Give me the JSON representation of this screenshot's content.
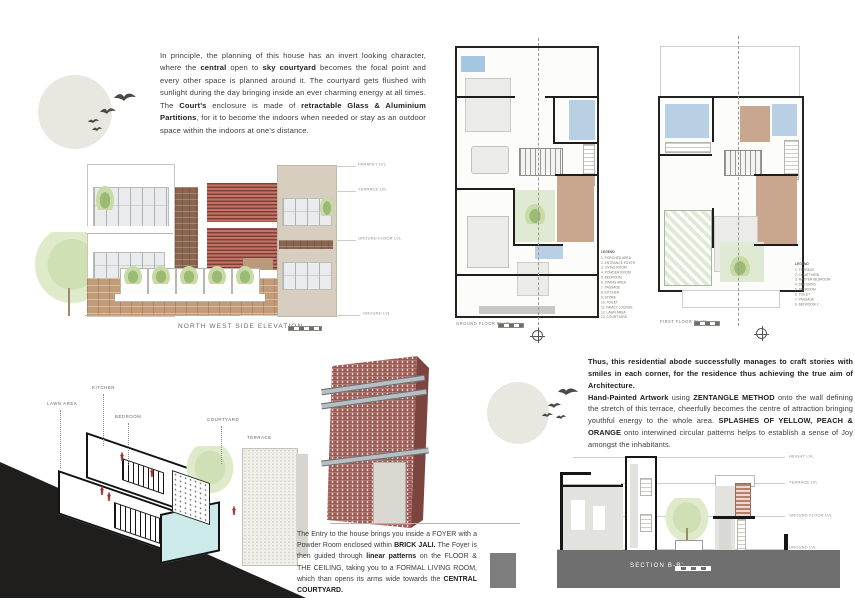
{
  "intro": {
    "segments": [
      {
        "text": "In principle, the planning of this house has an invert looking character, where the ",
        "bold": false
      },
      {
        "text": "central",
        "bold": true
      },
      {
        "text": " open to ",
        "bold": false
      },
      {
        "text": "sky courtyard",
        "bold": true
      },
      {
        "text": " becomes the focal point and every other space is planned around it. The courtyard gets flushed with sunlight during the day bringing inside an ever charming energy at all times. The ",
        "bold": false
      },
      {
        "text": "Court's",
        "bold": true
      },
      {
        "text": " enclosure is made of ",
        "bold": false
      },
      {
        "text": "retractable Glass & Aluminium Partitions",
        "bold": true
      },
      {
        "text": ", for it to become the indoors when needed or stay as an outdoor space within the indoors at one's distance.",
        "bold": false
      }
    ]
  },
  "elevation": {
    "title": "NORTH WEST SIDE ELEVATION",
    "levels": [
      "PARAPET LVL",
      "TERRACE LVL",
      "GROUND FLOOR LVL",
      "GROUND LVL"
    ]
  },
  "ground_floor_plan": {
    "title": "GROUND FLOOR PLAN",
    "legend_title": "LEGEND",
    "legend_items": [
      "1. PORCHED AREA",
      "2. ENTRANCE FOYER",
      "3. LIVING ROOM",
      "4. POWDER ROOM",
      "5. BEDROOM",
      "6. DINING AREA",
      "7. PASSAGE",
      "8. KITCHEN",
      "9. STORE",
      "10. TOILET",
      "11. FAMILY LOUNGE",
      "12. LAWN AREA",
      "13. COURTYARD"
    ]
  },
  "first_floor_plan": {
    "title": "FIRST FLOOR PLAN",
    "legend_title": "LEGEND",
    "legend_items": [
      "1. TERRACE",
      "2. COURTYARD",
      "3. MASTER BEDROOM",
      "4. DRESSING",
      "5. BEDROOM",
      "6. TOILET",
      "7. PASSAGE",
      "8. BEDROOM 2"
    ]
  },
  "axon": {
    "labels": {
      "lawn": "LAWN AREA",
      "kitchen": "KITCHEN",
      "bedroom": "BEDROOM",
      "courtyard": "COURTYARD",
      "terrace": "TERRACE"
    }
  },
  "entry": {
    "segments": [
      {
        "text": "The Entry to the house brings you inside a FOYER with a Powder Room enclosed within ",
        "bold": false
      },
      {
        "text": "BRICK JALI.",
        "bold": true
      },
      {
        "text": " The Foyer is then guided through ",
        "bold": false
      },
      {
        "text": "linear patterns",
        "bold": true
      },
      {
        "text": " on the FLOOR & THE CEILING, taking you to a FORMAL LIVING ROOM, which than opens its arms wide towards the ",
        "bold": false
      },
      {
        "text": "CENTRAL COURTYARD.",
        "bold": true
      }
    ]
  },
  "outro": {
    "segments": [
      {
        "text": "Thus, this residential abode successfully manages to craft stories with smiles in each corner, for the residence thus achieving the true aim of Architecture.",
        "bold": true
      },
      {
        "br": true
      },
      {
        "text": "Hand-Painted Artwork",
        "bold": true
      },
      {
        "text": " using ",
        "bold": false
      },
      {
        "text": "ZENTANGLE METHOD",
        "bold": true
      },
      {
        "text": " onto the wall defining the stretch of this terrace, cheerfully becomes the centre of attraction bringing youthful energy to the whole area. ",
        "bold": false
      },
      {
        "text": "SPLASHES OF YELLOW, PEACH & ORANGE",
        "bold": true
      },
      {
        "text": " onto interwined circular patterns helps to establish a sense of Joy amongst the inhabitants.",
        "bold": false
      }
    ]
  },
  "section": {
    "title": "SECTION B-B'",
    "levels": [
      "HEIGHT LVL",
      "TERRACE LVL",
      "GROUND FLOOR LVL",
      "GROUND LVL"
    ]
  },
  "colors": {
    "brick": "#9c5951",
    "jali_red": "#b5584c",
    "stone": "#8a6550",
    "plan_blue": "#b9cfe4",
    "plan_green": "#dfe9d3",
    "plan_brown": "#c9a78f",
    "ground_band_gray": "#6f6f6f",
    "wedge_black": "#1f1e1c",
    "circle_motif": "#e8e7e0"
  }
}
